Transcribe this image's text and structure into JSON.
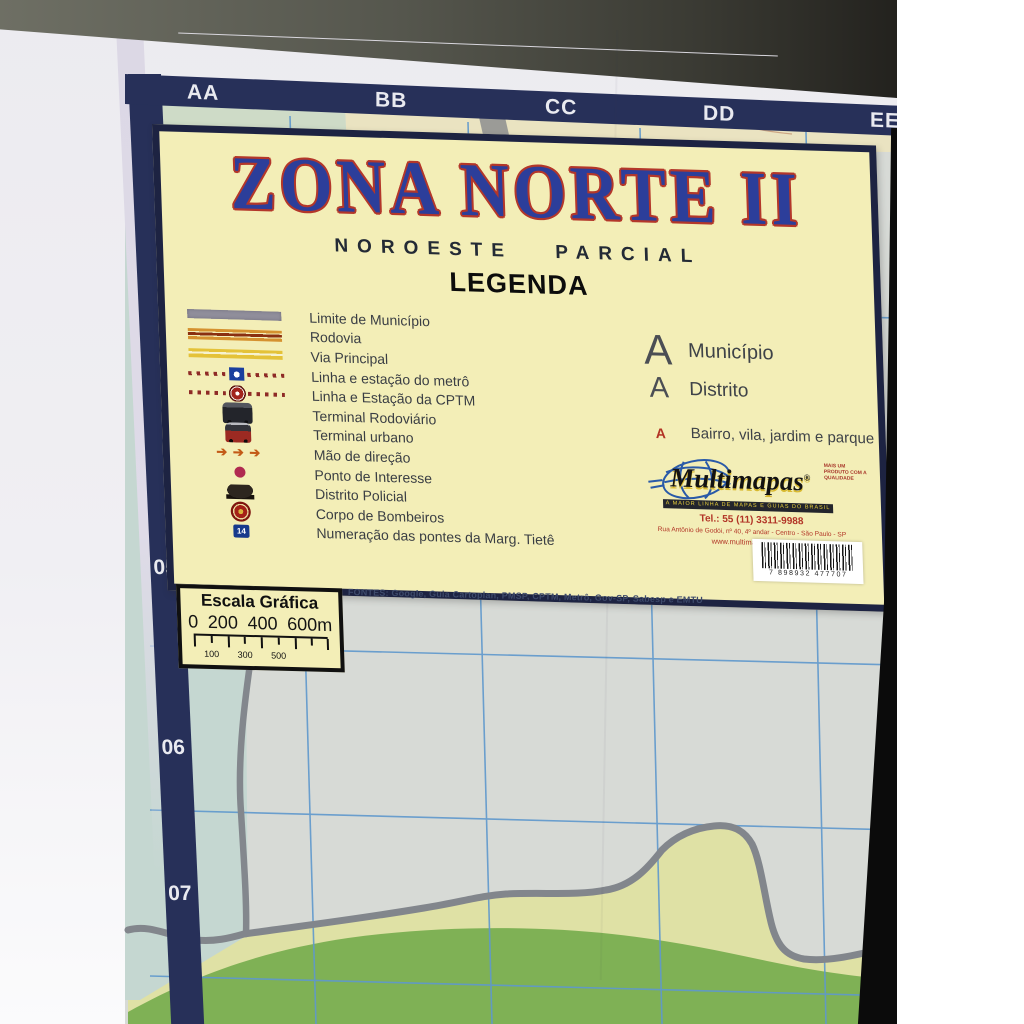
{
  "map": {
    "title": "ZONA NORTE II",
    "subtitle": "NOROESTE PARCIAL",
    "legend_heading": "LEGENDA",
    "grid": {
      "column_labels": [
        "AA",
        "BB",
        "CC",
        "DD",
        "EE"
      ],
      "row_labels": [
        "05",
        "06",
        "07"
      ]
    },
    "legend_items": [
      {
        "icon": "municipal-boundary-swatch",
        "label": "Limite de Município"
      },
      {
        "icon": "highway-swatch",
        "label": "Rodovia"
      },
      {
        "icon": "main-road-swatch",
        "label": "Via Principal"
      },
      {
        "icon": "metro-line-swatch",
        "label": "Linha e estação do metrô"
      },
      {
        "icon": "cptm-line-swatch",
        "label": "Linha e Estação da CPTM"
      },
      {
        "icon": "road-terminal-icon",
        "label": "Terminal Rodoviário"
      },
      {
        "icon": "urban-terminal-icon",
        "label": "Terminal urbano"
      },
      {
        "icon": "direction-arrows-icon",
        "label": "Mão de direção"
      },
      {
        "icon": "point-of-interest-icon",
        "label": "Ponto de Interesse"
      },
      {
        "icon": "police-district-icon",
        "label": "Distrito Policial"
      },
      {
        "icon": "fire-department-icon",
        "label": "Corpo de Bombeiros"
      },
      {
        "icon": "bridge-number-icon",
        "label": "Numeração das pontes da Marg. Tietê",
        "badge": "14"
      }
    ],
    "place_types": [
      {
        "symbol": "A",
        "label": "Município",
        "size": "large"
      },
      {
        "symbol": "A",
        "label": "Distrito",
        "size": "medium"
      },
      {
        "symbol": "A",
        "label": "Bairro, vila, jardim e parque",
        "size": "small"
      }
    ],
    "publisher": {
      "name": "Multimapas",
      "registered_mark": "®",
      "tagline": "MAIS UM PRODUTO COM A QUALIDADE",
      "banner": "A MAIOR LINHA DE MAPAS E GUIAS DO BRASIL",
      "phone": "Tel.: 55 (11) 3311-9988",
      "address": "Rua Antônio de Godói, nº 40, 4º andar - Centro - São Paulo - SP",
      "website": "www.multimapas.com.br",
      "barcode_digits": "7 898932 477707"
    },
    "scale_box": {
      "title": "Escala Gráfica",
      "top_labels": [
        "0",
        "200",
        "400",
        "600m"
      ],
      "bottom_labels": [
        "100",
        "300",
        "500"
      ]
    },
    "sources_note": "FONTES: Google, Guia Cartoplan, PMSP, CPTM, Metrô, Gov-SP, Sabesp e EMTU",
    "colors": {
      "panel_yellow": "#f3eeb7",
      "border_navy": "#1d2342",
      "title_blue": "#2c3e9a",
      "title_outline_red": "#b3372a",
      "grid_bar_navy": "#273059",
      "grid_line_blue": "#5f98cd",
      "map_green": "#7fb155",
      "map_teal": "#c5d7d1",
      "boundary_gray": "#82868c"
    }
  }
}
